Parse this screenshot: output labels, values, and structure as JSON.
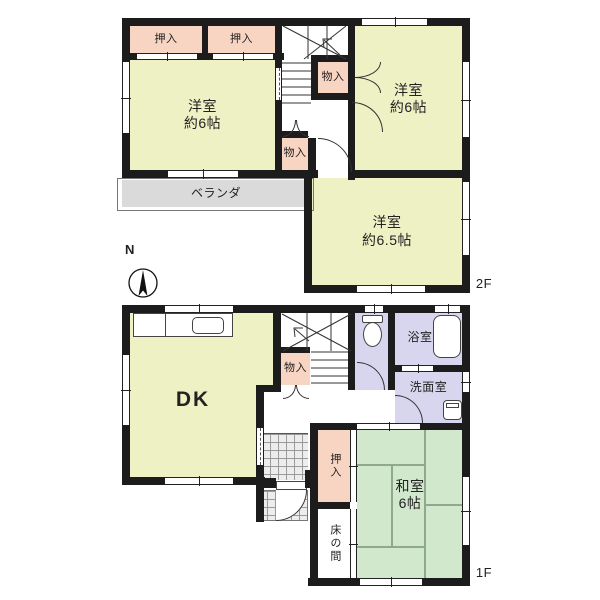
{
  "floor2": {
    "label": "2F",
    "oshiire1": "押入",
    "oshiire2": "押入",
    "room_left": {
      "name": "洋室",
      "size": "約6帖"
    },
    "room_right": {
      "name": "洋室",
      "size": "約6帖"
    },
    "room_65": {
      "name": "洋室",
      "size": "約6.5帖"
    },
    "monoire_upper": "物入",
    "monoire_lower": "物入",
    "veranda": "ベランダ"
  },
  "floor1": {
    "label": "1F",
    "dk": "DK",
    "monoire": "物入",
    "bathroom": "浴室",
    "washroom": "洗面室",
    "washitsu": {
      "name": "和室",
      "size": "6帖"
    },
    "oshiire": "押入",
    "tokonoma": "床の間"
  },
  "compass": {
    "north": "N"
  },
  "colors": {
    "room_yellow": "#edf1c4",
    "closet_pink": "#f8d4c3",
    "tatami_green": "#d1e8cd",
    "wet_lavender": "#d7d6ee",
    "veranda_gray": "#dadada",
    "wall_black": "#1c1c1c",
    "genkan_tile": "#ededed"
  }
}
